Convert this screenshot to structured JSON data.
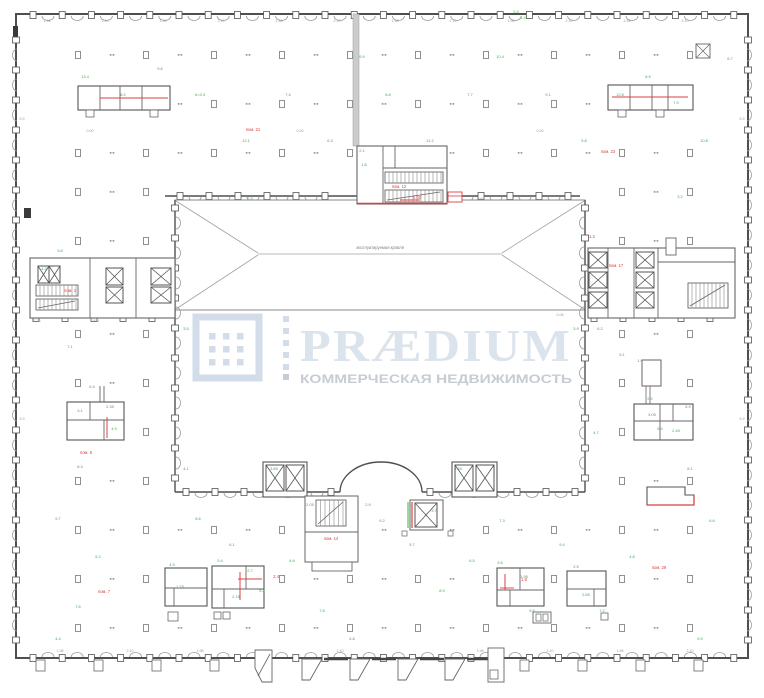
{
  "watermark": {
    "title": "PRÆDIUM",
    "subtitle": "КОММЕРЧЕСКАЯ НЕДВИЖИМОСТЬ",
    "logo_color": "#d3dde9",
    "title_color": "#dbe3ec",
    "subtitle_color": "#c7ccd2"
  },
  "plan": {
    "atrium_label": "эксплуатируемая кровля",
    "colors": {
      "wall": "#4f4f4f",
      "line": "#8a8a8a",
      "light": "#a8a8a8",
      "red": "#d84040",
      "green": "#3fae4a",
      "dim": "#9a9a9a"
    }
  },
  "annotations": {
    "rooms": [
      [
        253,
        131,
        "пом. 21"
      ],
      [
        608,
        153,
        "пом. 23"
      ],
      [
        70,
        292,
        "пом. 1"
      ],
      [
        616,
        267,
        "пом. 17"
      ],
      [
        399,
        188,
        "пом. 12"
      ],
      [
        331,
        540,
        "пом. 14"
      ],
      [
        86,
        454,
        "пом. 5"
      ],
      [
        659,
        569,
        "пом. 29"
      ],
      [
        104,
        593,
        "пом. 7"
      ],
      [
        592,
        238,
        "1.2"
      ],
      [
        276,
        578,
        "2.4"
      ],
      [
        524,
        581,
        "1.8"
      ],
      [
        417,
        199,
        "0.00"
      ]
    ],
    "areas": [
      [
        85,
        78,
        "13.4"
      ],
      [
        123,
        96,
        "8.2"
      ],
      [
        160,
        70,
        "9.6"
      ],
      [
        200,
        96,
        "h=3.3"
      ],
      [
        246,
        142,
        "12.1"
      ],
      [
        288,
        96,
        "7.4"
      ],
      [
        330,
        142,
        "6.3"
      ],
      [
        362,
        58,
        "9.9"
      ],
      [
        388,
        96,
        "8.8"
      ],
      [
        430,
        142,
        "11.2"
      ],
      [
        470,
        96,
        "7.7"
      ],
      [
        500,
        58,
        "10.4"
      ],
      [
        516,
        13,
        "2.4"
      ],
      [
        523,
        19,
        "1.2"
      ],
      [
        548,
        96,
        "9.1"
      ],
      [
        584,
        142,
        "5.8"
      ],
      [
        620,
        96,
        "12.6"
      ],
      [
        648,
        78,
        "8.5"
      ],
      [
        676,
        104,
        "7.9"
      ],
      [
        704,
        142,
        "10.8"
      ],
      [
        730,
        60,
        "6.7"
      ],
      [
        44,
        270,
        "4.2"
      ],
      [
        60,
        252,
        "3.8"
      ],
      [
        96,
        322,
        "5.5"
      ],
      [
        70,
        348,
        "7.1"
      ],
      [
        92,
        388,
        "6.4"
      ],
      [
        114,
        430,
        "4.9"
      ],
      [
        80,
        468,
        "8.3"
      ],
      [
        58,
        520,
        "9.7"
      ],
      [
        98,
        558,
        "5.2"
      ],
      [
        78,
        608,
        "7.6"
      ],
      [
        58,
        640,
        "4.4"
      ],
      [
        600,
        330,
        "6.2"
      ],
      [
        622,
        356,
        "5.1"
      ],
      [
        596,
        434,
        "4.7"
      ],
      [
        688,
        408,
        "6.9"
      ],
      [
        660,
        430,
        "5.4"
      ],
      [
        690,
        470,
        "8.1"
      ],
      [
        712,
        522,
        "6.6"
      ],
      [
        632,
        558,
        "4.8"
      ],
      [
        602,
        612,
        "7.2"
      ],
      [
        700,
        640,
        "5.9"
      ],
      [
        186,
        330,
        "3.5"
      ],
      [
        576,
        330,
        "3.9"
      ],
      [
        186,
        470,
        "4.1"
      ],
      [
        250,
        200,
        "2.8"
      ],
      [
        480,
        200,
        "2.6"
      ],
      [
        680,
        198,
        "3.2"
      ],
      [
        198,
        520,
        "8.6"
      ],
      [
        232,
        546,
        "6.1"
      ],
      [
        262,
        592,
        "5.3"
      ],
      [
        292,
        562,
        "4.6"
      ],
      [
        322,
        612,
        "7.8"
      ],
      [
        352,
        640,
        "6.8"
      ],
      [
        382,
        522,
        "9.2"
      ],
      [
        412,
        546,
        "5.7"
      ],
      [
        442,
        592,
        "8.9"
      ],
      [
        472,
        562,
        "6.5"
      ],
      [
        502,
        522,
        "7.3"
      ],
      [
        532,
        612,
        "5.6"
      ],
      [
        562,
        546,
        "9.4"
      ],
      [
        434,
        512,
        "3.7"
      ],
      [
        368,
        506,
        "2.9"
      ],
      [
        172,
        566,
        "4.3"
      ],
      [
        220,
        562,
        "3.4"
      ],
      [
        250,
        572,
        "2.7"
      ],
      [
        500,
        564,
        "3.6"
      ],
      [
        576,
        568,
        "2.5"
      ],
      [
        640,
        362,
        "1.9"
      ],
      [
        650,
        400,
        "2.2"
      ],
      [
        362,
        152,
        "2.1"
      ],
      [
        364,
        166,
        "1.8"
      ],
      [
        80,
        412,
        "3.1"
      ],
      [
        110,
        408,
        "2.35"
      ],
      [
        652,
        416,
        "3.05"
      ],
      [
        676,
        432,
        "2.45"
      ],
      [
        180,
        588,
        "1.75"
      ],
      [
        236,
        598,
        "2.15"
      ],
      [
        524,
        578,
        "1.95"
      ],
      [
        586,
        596,
        "2.65"
      ],
      [
        274,
        470,
        "3.85"
      ],
      [
        310,
        506,
        "2.05"
      ],
      [
        458,
        470,
        "3.45"
      ]
    ],
    "dims": [
      [
        47,
        22,
        "1.98"
      ],
      [
        105,
        22,
        "2.10"
      ],
      [
        163,
        22,
        "1.98"
      ],
      [
        221,
        22,
        "2.10"
      ],
      [
        279,
        22,
        "1.98"
      ],
      [
        337,
        22,
        "2.10"
      ],
      [
        395,
        22,
        "1.98"
      ],
      [
        453,
        22,
        "2.10"
      ],
      [
        511,
        22,
        "1.98"
      ],
      [
        569,
        22,
        "2.10"
      ],
      [
        627,
        22,
        "1.98"
      ],
      [
        685,
        22,
        "2.10"
      ],
      [
        60,
        652,
        "1.98"
      ],
      [
        130,
        652,
        "2.10"
      ],
      [
        200,
        652,
        "1.98"
      ],
      [
        340,
        652,
        "2.10"
      ],
      [
        480,
        652,
        "1.98"
      ],
      [
        550,
        652,
        "2.10"
      ],
      [
        620,
        652,
        "1.98"
      ],
      [
        690,
        652,
        "2.10"
      ],
      [
        36,
        322,
        "17.78"
      ],
      [
        206,
        316,
        "2.08"
      ],
      [
        560,
        316,
        "2.08"
      ],
      [
        22,
        120,
        "5.9"
      ],
      [
        22,
        420,
        "5.9"
      ],
      [
        742,
        120,
        "5.9"
      ],
      [
        742,
        420,
        "5.9"
      ],
      [
        90,
        132,
        "0.00"
      ],
      [
        300,
        132,
        "0.00"
      ],
      [
        540,
        132,
        "0.00"
      ]
    ]
  }
}
